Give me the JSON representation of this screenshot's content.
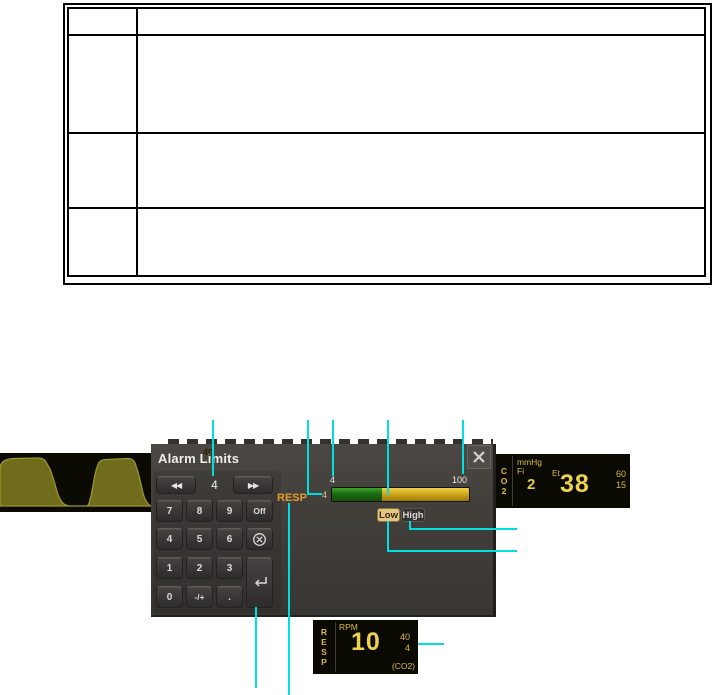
{
  "table": {
    "rows": [
      [
        "",
        ""
      ],
      [
        "",
        ""
      ],
      [
        "",
        ""
      ],
      [
        "",
        ""
      ]
    ]
  },
  "monitor": {
    "dialog": {
      "title": "Alarm Limits",
      "spinner": {
        "value": "4"
      },
      "keypad": {
        "keys": [
          "7",
          "8",
          "9",
          "Off",
          "4",
          "5",
          "6",
          "1",
          "2",
          "3",
          "0",
          "-/+",
          "."
        ]
      },
      "parameter_label": "RESP",
      "slider": {
        "scale_min": "4",
        "scale_max": "100",
        "marker_value": "40",
        "low_value": "4"
      },
      "low_button": "Low",
      "high_button": "High"
    },
    "co2_panel": {
      "letters": [
        "C",
        "O",
        "2"
      ],
      "unit": "mmHg",
      "fi_label": "Fi",
      "fi_value": "2",
      "et_label": "Et",
      "et_value": "38",
      "limit_high": "60",
      "limit_low": "15"
    },
    "resp_panel": {
      "letters": [
        "R",
        "E",
        "S",
        "P"
      ],
      "unit": "RPM",
      "value": "10",
      "limit_high": "40",
      "limit_low": "4",
      "source_label": "(CO2)"
    }
  },
  "colors": {
    "callout": "#00dfdf",
    "monitor_yellow": "#d8bb3b",
    "value_yellow": "#eed34a",
    "resp_orange": "#e09b2d",
    "slider_green": "#1c6b12",
    "slider_yellow": "#d2a71b",
    "low_button_bg": "#e6c67e"
  }
}
